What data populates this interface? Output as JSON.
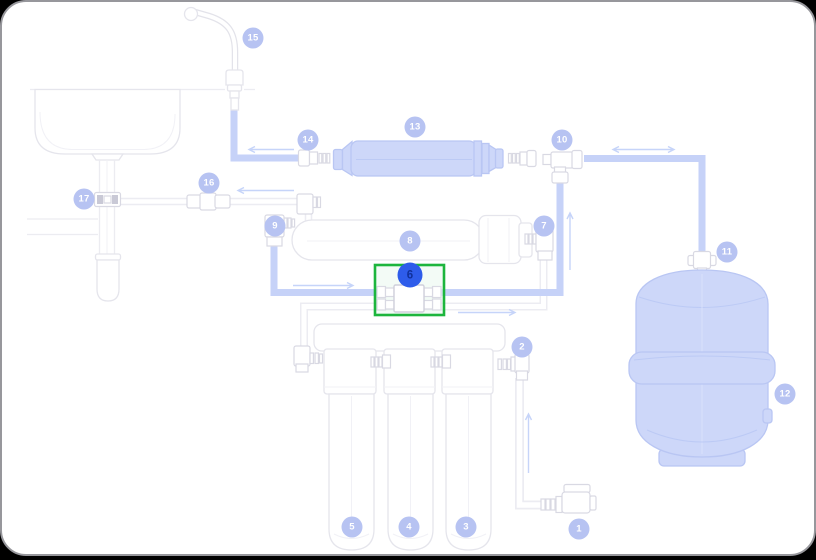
{
  "app": {
    "type": "parts-diagram-viewer",
    "surface_background": "#ffffff",
    "frame_background": "#000000",
    "frame_border": "#97979c"
  },
  "diagram": {
    "subject": "reverse-osmosis-water-filter-system",
    "selected_part_id": "6",
    "selection": {
      "highlight_box_color": "#1db53d",
      "badge_fill": "#2e5cea",
      "badge_text_color": "#10309b"
    },
    "badge_style": {
      "fill": "#b7c3f2",
      "text_color": "#ffffff"
    },
    "palette": {
      "tube_blue": "#c6d2f8",
      "component_blue": "#cdd7f9",
      "component_blue_stroke": "#b9c6f3",
      "outline_gray": "#e5e5ec",
      "faint_pipe_gray": "#ececf2",
      "arrow_blue": "#c6d4f9"
    },
    "parts": [
      {
        "id": "1",
        "x": 577,
        "y": 527,
        "selected": false
      },
      {
        "id": "2",
        "x": 520,
        "y": 345,
        "selected": false
      },
      {
        "id": "3",
        "x": 464,
        "y": 525,
        "selected": false
      },
      {
        "id": "4",
        "x": 407,
        "y": 525,
        "selected": false
      },
      {
        "id": "5",
        "x": 350,
        "y": 525,
        "selected": false
      },
      {
        "id": "6",
        "x": 408,
        "y": 273,
        "selected": true
      },
      {
        "id": "7",
        "x": 542,
        "y": 224,
        "selected": false
      },
      {
        "id": "8",
        "x": 408,
        "y": 239,
        "selected": false
      },
      {
        "id": "9",
        "x": 273,
        "y": 224,
        "selected": false
      },
      {
        "id": "10",
        "x": 560,
        "y": 138,
        "selected": false
      },
      {
        "id": "11",
        "x": 725,
        "y": 250,
        "selected": false
      },
      {
        "id": "12",
        "x": 783,
        "y": 392,
        "selected": false
      },
      {
        "id": "13",
        "x": 413,
        "y": 125,
        "selected": false
      },
      {
        "id": "14",
        "x": 306,
        "y": 138,
        "selected": false
      },
      {
        "id": "15",
        "x": 251,
        "y": 36,
        "selected": false
      },
      {
        "id": "16",
        "x": 207,
        "y": 181,
        "selected": false
      },
      {
        "id": "17",
        "x": 82,
        "y": 197,
        "selected": false
      }
    ]
  }
}
